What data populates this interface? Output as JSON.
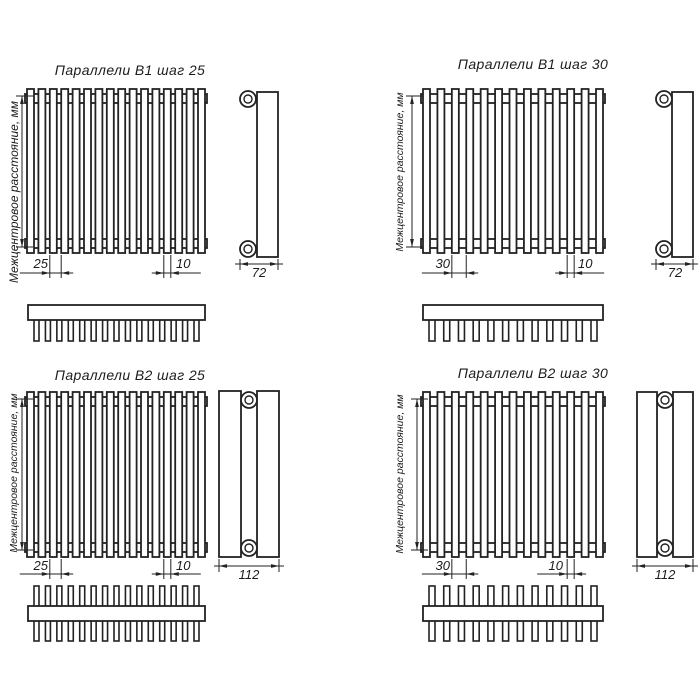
{
  "drawing": {
    "vertical_axis_label": "Межцентровое расстояние, мм",
    "line_color": "#222222",
    "background_color": "#ffffff",
    "panels": [
      {
        "id": "b1-step-25",
        "title": "Параллели В1 шаг 25",
        "step_label": "25",
        "tube_width_label": "10",
        "depth_label": "72",
        "rows": 1,
        "tube_count": 16,
        "teeth_count": 15
      },
      {
        "id": "b1-step-30",
        "title": "Параллели В1 шаг 30",
        "step_label": "30",
        "tube_width_label": "10",
        "depth_label": "72",
        "rows": 1,
        "tube_count": 13,
        "teeth_count": 12
      },
      {
        "id": "b2-step-25",
        "title": "Параллели В2 шаг 25",
        "step_label": "25",
        "tube_width_label": "10",
        "depth_label": "112",
        "rows": 2,
        "tube_count": 16,
        "teeth_count": 15
      },
      {
        "id": "b2-step-30",
        "title": "Параллели В2 шаг 30",
        "step_label": "30",
        "tube_width_label": "10",
        "depth_label": "112",
        "rows": 2,
        "tube_count": 13,
        "teeth_count": 12
      }
    ]
  }
}
